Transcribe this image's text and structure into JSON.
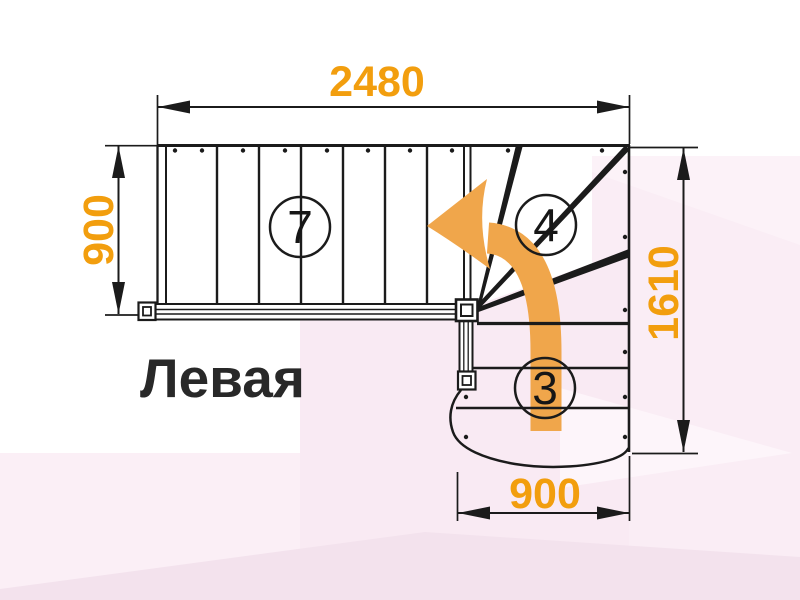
{
  "plan": {
    "title": "Левая",
    "type_label": "stair-plan-left-turn"
  },
  "dimensions": {
    "top_width": "2480",
    "left_depth": "900",
    "right_height": "1610",
    "bottom_width": "900"
  },
  "steps": {
    "top_flight_count": "7",
    "winder_count": "4",
    "bottom_flight_count": "3"
  },
  "colors": {
    "dimension_text": "#F29E0E",
    "arrow_orange": "#F0A64B",
    "line_black": "#1B1B1B",
    "bg_pink": "#FAEDF5",
    "bg_pink_dark": "#F3E2ED",
    "bg_pink_light": "#FDF5FA",
    "title_color": "#282828"
  }
}
